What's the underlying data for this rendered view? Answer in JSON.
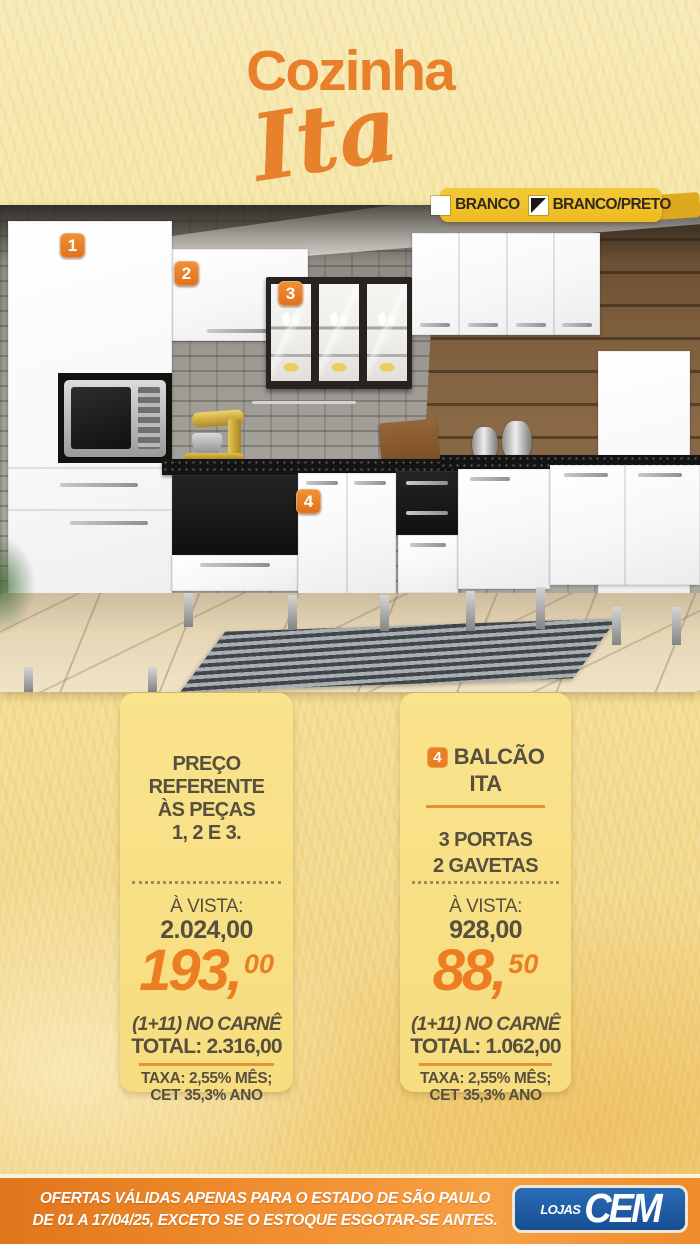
{
  "title": {
    "line1": "Cozinha",
    "line2": "Ita"
  },
  "color_options": {
    "options": [
      {
        "label": "BRANCO"
      },
      {
        "label": "BRANCO/PRETO"
      }
    ]
  },
  "photo": {
    "markers": [
      "1",
      "2",
      "3",
      "4"
    ]
  },
  "cards": [
    {
      "title_lines": [
        "PREÇO",
        "REFERENTE",
        "ÀS PEÇAS",
        "1, 2 E 3."
      ],
      "avista_label": "À VISTA:",
      "cash_price": "2.024,00",
      "installment_int": "193",
      "installment_comma": ",",
      "installment_cents": "00",
      "carne_label": "(1+11) NO CARNÊ",
      "total_label": "TOTAL: 2.316,00",
      "tax_line1": "TAXA: 2,55% MÊS;",
      "tax_line2": "CET 35,3% ANO"
    },
    {
      "badge": "4",
      "name_line1": "BALCÃO",
      "name_line2": "ITA",
      "feature_line1": "3 PORTAS",
      "feature_line2": "2 GAVETAS",
      "avista_label": "À VISTA:",
      "cash_price": "928,00",
      "installment_int": "88",
      "installment_comma": ",",
      "installment_cents": "50",
      "carne_label": "(1+11) NO CARNÊ",
      "total_label": "TOTAL: 1.062,00",
      "tax_line1": "TAXA: 2,55% MÊS;",
      "tax_line2": "CET 35,3% ANO"
    }
  ],
  "footer": {
    "disclaimer_line1": "OFERTAS VÁLIDAS APENAS PARA O ESTADO DE SÃO PAULO",
    "disclaimer_line2": "DE 01 A 17/04/25, EXCETO SE O ESTOQUE ESGOTAR-SE ANTES.",
    "logo_small": "LOJAS",
    "logo_big": "CEM"
  },
  "colors": {
    "accent_orange": "#ED7D23",
    "title_orange": "#E8802B",
    "badge_yellow": "#F0C22C",
    "card_yellow": "#F8E086",
    "text_brown": "#57503E",
    "footer_blue": "#1A57A5"
  }
}
